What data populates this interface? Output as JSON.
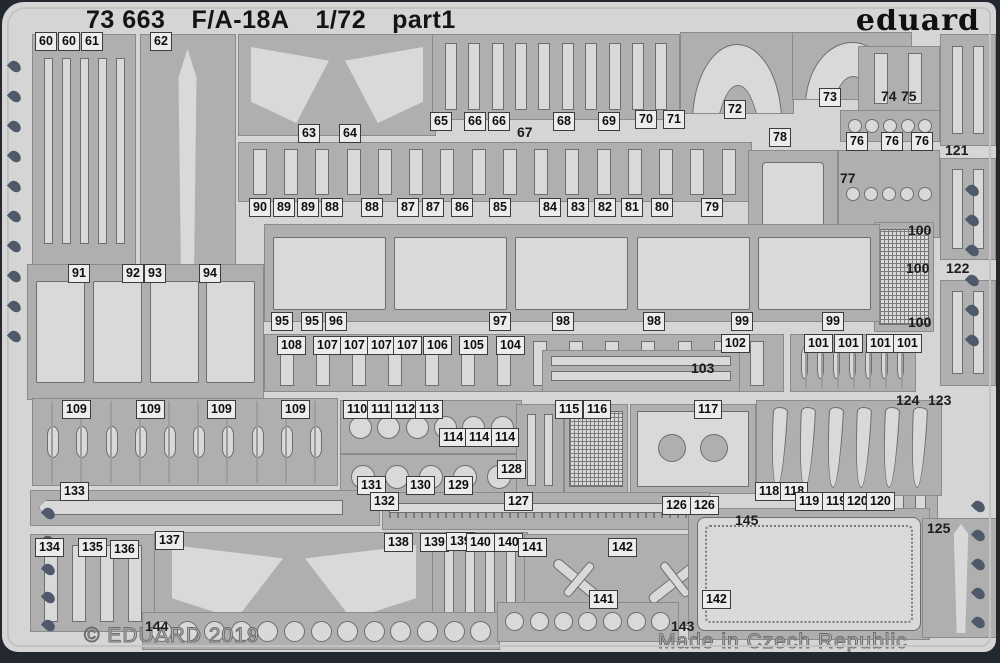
{
  "header": {
    "catalog": "73 663",
    "aircraft": "F/A-18A",
    "scale": "1/72",
    "part": "part1",
    "brand": "eduard"
  },
  "footer": {
    "copyright": "© EDUARD 2019",
    "origin": "Made in Czech Republic"
  },
  "colors": {
    "background": "#23272e",
    "sheet": "#d5d5d5",
    "panel": "#afafaf",
    "part": "#d9d9d9",
    "outline": "#6e6e6e",
    "hole": "#4e5a69",
    "label_bg": "#ececec",
    "text": "#141414",
    "etched": "#8f8f8f"
  },
  "sheet": {
    "panels": [
      [
        30,
        32,
        102,
        232,
        "vstrips",
        5
      ],
      [
        138,
        32,
        94,
        342,
        "fin",
        1
      ],
      [
        236,
        32,
        196,
        100,
        "wedges",
        2
      ],
      [
        430,
        32,
        246,
        84,
        "vstrips",
        10
      ],
      [
        678,
        30,
        112,
        80,
        "arch",
        1
      ],
      [
        790,
        30,
        118,
        66,
        "arch",
        1
      ],
      [
        856,
        44,
        80,
        64,
        "vstrips",
        2
      ],
      [
        838,
        108,
        98,
        30,
        "circles",
        5
      ],
      [
        938,
        32,
        54,
        110,
        "vstrips",
        2
      ],
      [
        236,
        140,
        512,
        58,
        "vstrips",
        16
      ],
      [
        746,
        148,
        88,
        88,
        "blank",
        1
      ],
      [
        836,
        148,
        100,
        86,
        "circles",
        5
      ],
      [
        872,
        220,
        58,
        108,
        "mesh",
        1
      ],
      [
        938,
        156,
        54,
        100,
        "vstrips",
        2
      ],
      [
        938,
        278,
        54,
        104,
        "vstrips",
        2
      ],
      [
        25,
        262,
        235,
        134,
        "plates",
        4
      ],
      [
        262,
        222,
        614,
        96,
        "plates",
        5
      ],
      [
        262,
        332,
        518,
        56,
        "vstrips",
        14
      ],
      [
        540,
        348,
        196,
        40,
        "hstrips",
        2
      ],
      [
        788,
        332,
        124,
        56,
        "bombs",
        7
      ],
      [
        878,
        398,
        56,
        192,
        "vstrips",
        2
      ],
      [
        30,
        396,
        304,
        86,
        "bombs",
        10
      ],
      [
        338,
        398,
        180,
        52,
        "circles",
        6
      ],
      [
        338,
        452,
        180,
        44,
        "circles",
        5
      ],
      [
        514,
        402,
        46,
        90,
        "vstrips",
        2
      ],
      [
        562,
        402,
        62,
        88,
        "mesh",
        1
      ],
      [
        628,
        402,
        124,
        88,
        "bay",
        2
      ],
      [
        754,
        398,
        184,
        94,
        "blades",
        6
      ],
      [
        28,
        488,
        348,
        34,
        "blade",
        1
      ],
      [
        380,
        490,
        326,
        36,
        "zigzag",
        2
      ],
      [
        28,
        532,
        124,
        96,
        "vstrips",
        4
      ],
      [
        152,
        530,
        278,
        98,
        "wedges",
        2
      ],
      [
        430,
        530,
        94,
        96,
        "vstrips",
        4
      ],
      [
        522,
        532,
        200,
        90,
        "jets",
        2
      ],
      [
        140,
        610,
        356,
        36,
        "circles",
        13
      ],
      [
        495,
        600,
        180,
        38,
        "circles",
        7
      ],
      [
        686,
        506,
        240,
        130,
        "door",
        1
      ],
      [
        920,
        516,
        76,
        118,
        "fin",
        1
      ]
    ],
    "labels": [
      [
        "60",
        33,
        30,
        0
      ],
      [
        "60",
        56,
        30,
        0
      ],
      [
        "61",
        79,
        30,
        0
      ],
      [
        "62",
        148,
        30,
        0
      ],
      [
        "63",
        296,
        122,
        0
      ],
      [
        "64",
        337,
        122,
        0
      ],
      [
        "65",
        428,
        110,
        0
      ],
      [
        "66",
        462,
        110,
        0
      ],
      [
        "66",
        486,
        110,
        0
      ],
      [
        "67",
        512,
        122,
        1
      ],
      [
        "68",
        551,
        110,
        0
      ],
      [
        "69",
        596,
        110,
        0
      ],
      [
        "70",
        633,
        108,
        0
      ],
      [
        "71",
        661,
        108,
        0
      ],
      [
        "72",
        722,
        98,
        0
      ],
      [
        "73",
        817,
        86,
        0
      ],
      [
        "74",
        876,
        86,
        1
      ],
      [
        "75",
        896,
        86,
        1
      ],
      [
        "76",
        844,
        130,
        0
      ],
      [
        "76",
        879,
        130,
        0
      ],
      [
        "76",
        909,
        130,
        0
      ],
      [
        "121",
        940,
        140,
        1
      ],
      [
        "90",
        247,
        196,
        0
      ],
      [
        "89",
        271,
        196,
        0
      ],
      [
        "89",
        295,
        196,
        0
      ],
      [
        "88",
        319,
        196,
        0
      ],
      [
        "88",
        359,
        196,
        0
      ],
      [
        "87",
        395,
        196,
        0
      ],
      [
        "87",
        420,
        196,
        0
      ],
      [
        "86",
        449,
        196,
        0
      ],
      [
        "85",
        487,
        196,
        0
      ],
      [
        "84",
        537,
        196,
        0
      ],
      [
        "83",
        565,
        196,
        0
      ],
      [
        "82",
        592,
        196,
        0
      ],
      [
        "81",
        619,
        196,
        0
      ],
      [
        "80",
        649,
        196,
        0
      ],
      [
        "79",
        699,
        196,
        0
      ],
      [
        "78",
        767,
        126,
        0
      ],
      [
        "77",
        835,
        168,
        1
      ],
      [
        "100",
        903,
        220,
        1
      ],
      [
        "100",
        901,
        258,
        1
      ],
      [
        "100",
        903,
        312,
        1
      ],
      [
        "122",
        941,
        258,
        1
      ],
      [
        "91",
        66,
        262,
        0
      ],
      [
        "92",
        120,
        262,
        0
      ],
      [
        "93",
        142,
        262,
        0
      ],
      [
        "94",
        197,
        262,
        0
      ],
      [
        "95",
        269,
        310,
        0
      ],
      [
        "95",
        299,
        310,
        0
      ],
      [
        "96",
        323,
        310,
        0
      ],
      [
        "97",
        487,
        310,
        0
      ],
      [
        "98",
        550,
        310,
        0
      ],
      [
        "98",
        641,
        310,
        0
      ],
      [
        "99",
        729,
        310,
        0
      ],
      [
        "99",
        820,
        310,
        0
      ],
      [
        "108",
        275,
        334,
        0
      ],
      [
        "107",
        311,
        334,
        0
      ],
      [
        "107",
        338,
        334,
        0
      ],
      [
        "107",
        365,
        334,
        0
      ],
      [
        "107",
        391,
        334,
        0
      ],
      [
        "106",
        421,
        334,
        0
      ],
      [
        "105",
        457,
        334,
        0
      ],
      [
        "104",
        494,
        334,
        0
      ],
      [
        "103",
        686,
        358,
        1
      ],
      [
        "102",
        719,
        332,
        0
      ],
      [
        "101",
        802,
        332,
        0
      ],
      [
        "101",
        832,
        332,
        0
      ],
      [
        "101",
        864,
        332,
        0
      ],
      [
        "101",
        891,
        332,
        0
      ],
      [
        "124",
        891,
        390,
        1
      ],
      [
        "123",
        923,
        390,
        1
      ],
      [
        "109",
        60,
        398,
        0
      ],
      [
        "109",
        134,
        398,
        0
      ],
      [
        "109",
        205,
        398,
        0
      ],
      [
        "109",
        279,
        398,
        0
      ],
      [
        "110",
        341,
        398,
        0
      ],
      [
        "111",
        365,
        398,
        0
      ],
      [
        "112",
        389,
        398,
        0
      ],
      [
        "113",
        413,
        398,
        0
      ],
      [
        "114",
        437,
        426,
        0
      ],
      [
        "114",
        463,
        426,
        0
      ],
      [
        "114",
        489,
        426,
        0
      ],
      [
        "115",
        553,
        398,
        0
      ],
      [
        "116",
        581,
        398,
        0
      ],
      [
        "117",
        692,
        398,
        0
      ],
      [
        "128",
        495,
        458,
        0
      ],
      [
        "131",
        355,
        474,
        0
      ],
      [
        "130",
        404,
        474,
        0
      ],
      [
        "129",
        442,
        474,
        0
      ],
      [
        "133",
        58,
        480,
        0
      ],
      [
        "132",
        368,
        490,
        0
      ],
      [
        "127",
        502,
        490,
        0
      ],
      [
        "118",
        753,
        480,
        0
      ],
      [
        "118",
        778,
        480,
        0
      ],
      [
        "119",
        793,
        490,
        0
      ],
      [
        "119",
        820,
        490,
        0
      ],
      [
        "120",
        841,
        490,
        0
      ],
      [
        "120",
        864,
        490,
        0
      ],
      [
        "126",
        660,
        494,
        0
      ],
      [
        "126",
        688,
        494,
        0
      ],
      [
        "134",
        33,
        536,
        0
      ],
      [
        "135",
        76,
        536,
        0
      ],
      [
        "136",
        108,
        538,
        0
      ],
      [
        "137",
        153,
        529,
        0
      ],
      [
        "138",
        382,
        531,
        0
      ],
      [
        "139",
        418,
        531,
        0
      ],
      [
        "139",
        444,
        530,
        0
      ],
      [
        "140",
        464,
        531,
        0
      ],
      [
        "140",
        492,
        531,
        0
      ],
      [
        "141",
        516,
        536,
        0
      ],
      [
        "142",
        606,
        536,
        0
      ],
      [
        "141",
        587,
        588,
        0
      ],
      [
        "142",
        700,
        588,
        0
      ],
      [
        "143",
        666,
        616,
        1
      ],
      [
        "144",
        140,
        616,
        1
      ],
      [
        "145",
        730,
        510,
        1
      ],
      [
        "125",
        922,
        518,
        1
      ]
    ],
    "holes": [
      [
        8,
        58
      ],
      [
        8,
        88
      ],
      [
        8,
        118
      ],
      [
        8,
        148
      ],
      [
        8,
        178
      ],
      [
        8,
        208
      ],
      [
        8,
        238
      ],
      [
        8,
        268
      ],
      [
        8,
        298
      ],
      [
        8,
        328
      ],
      [
        42,
        505
      ],
      [
        42,
        533
      ],
      [
        42,
        561
      ],
      [
        42,
        589
      ],
      [
        42,
        617
      ],
      [
        966,
        182
      ],
      [
        966,
        212
      ],
      [
        966,
        242
      ],
      [
        966,
        272
      ],
      [
        966,
        302
      ],
      [
        966,
        332
      ],
      [
        972,
        498
      ],
      [
        972,
        527
      ],
      [
        972,
        556
      ],
      [
        972,
        585
      ],
      [
        972,
        614
      ]
    ]
  }
}
